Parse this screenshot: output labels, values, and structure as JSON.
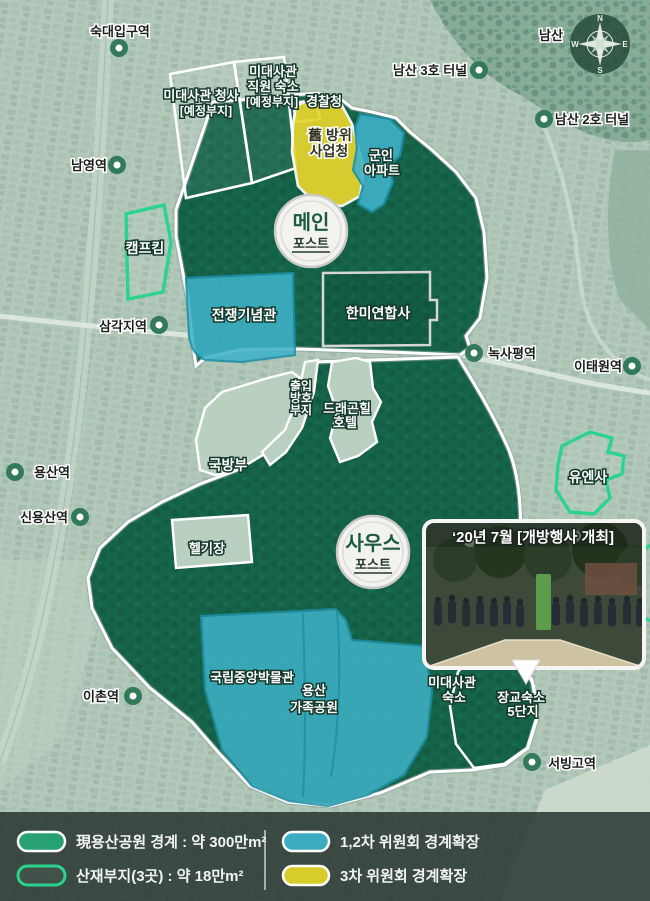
{
  "map": {
    "compass": {
      "n": "N",
      "e": "E",
      "s": "S",
      "w": "W"
    },
    "place_labels": {
      "namsan": "남산",
      "namsan_tunnel3": "남산 3호 터널",
      "namsan_tunnel2": "남산 2호 터널"
    },
    "stations": [
      {
        "label": "숙대입구역"
      },
      {
        "label": "남영역"
      },
      {
        "label": "삼각지역"
      },
      {
        "label": "용산역"
      },
      {
        "label": "신용산역"
      },
      {
        "label": "이촌역"
      },
      {
        "label": "녹사평역"
      },
      {
        "label": "이태원역"
      },
      {
        "label": "서빙고역"
      }
    ],
    "posts": {
      "main": {
        "name": "메인",
        "sub": "포스트"
      },
      "south": {
        "name": "사우스",
        "sub": "포스트"
      }
    },
    "sites": {
      "embassy_office": {
        "line1": "미대사관 청사",
        "line2": "[예정부지]"
      },
      "embassy_staff": {
        "line1": "미대사관",
        "line2": "직원 숙소",
        "line3": "[예정부지]"
      },
      "police": "경찰청",
      "old_dapa": {
        "line1": "舊 방위",
        "line2": "사업청"
      },
      "military_apt": {
        "line1": "군인",
        "line2": "아파트"
      },
      "camp_kim": "캠프킴",
      "war_memorial": "전쟁기념관",
      "cfc": "한미연합사",
      "access_site": {
        "line1": "출입",
        "line2": "방호",
        "line3": "부지"
      },
      "dragon_hill": {
        "line1": "드래곤힐",
        "line2": "호텔"
      },
      "mnd": "국방부",
      "heliport": "헬기장",
      "un_command": "유엔사",
      "museum": "국립중앙박물관",
      "family_park": {
        "line1": "용산",
        "line2": "가족공원"
      },
      "embassy_housing": {
        "line1": "미대사관",
        "line2": "숙소"
      },
      "officer_housing": {
        "line1": "장교숙소",
        "line2": "5단지"
      }
    },
    "photo": {
      "caption": "‘20년 7월 [개방행사 개최]"
    }
  },
  "legend": {
    "items": [
      {
        "swatch": "park-boundary",
        "label": "現용산공원 경계 : 약 300만m²"
      },
      {
        "swatch": "scattered-sites",
        "label": "산재부지(3곳) : 약 18만m²"
      },
      {
        "swatch": "committee-1-2",
        "label": "1,2차 위원회 경계확장"
      },
      {
        "swatch": "committee-3",
        "label": "3차 위원회 경계확장"
      }
    ]
  },
  "colors": {
    "park_green": "#156349",
    "park_green_dark": "#0e4f3a",
    "expansion_cyan": "#3fb2c8",
    "expansion_yellow": "#e5d42f",
    "scattered_outline": "#2bd48c",
    "background": "#b2c9ba"
  }
}
